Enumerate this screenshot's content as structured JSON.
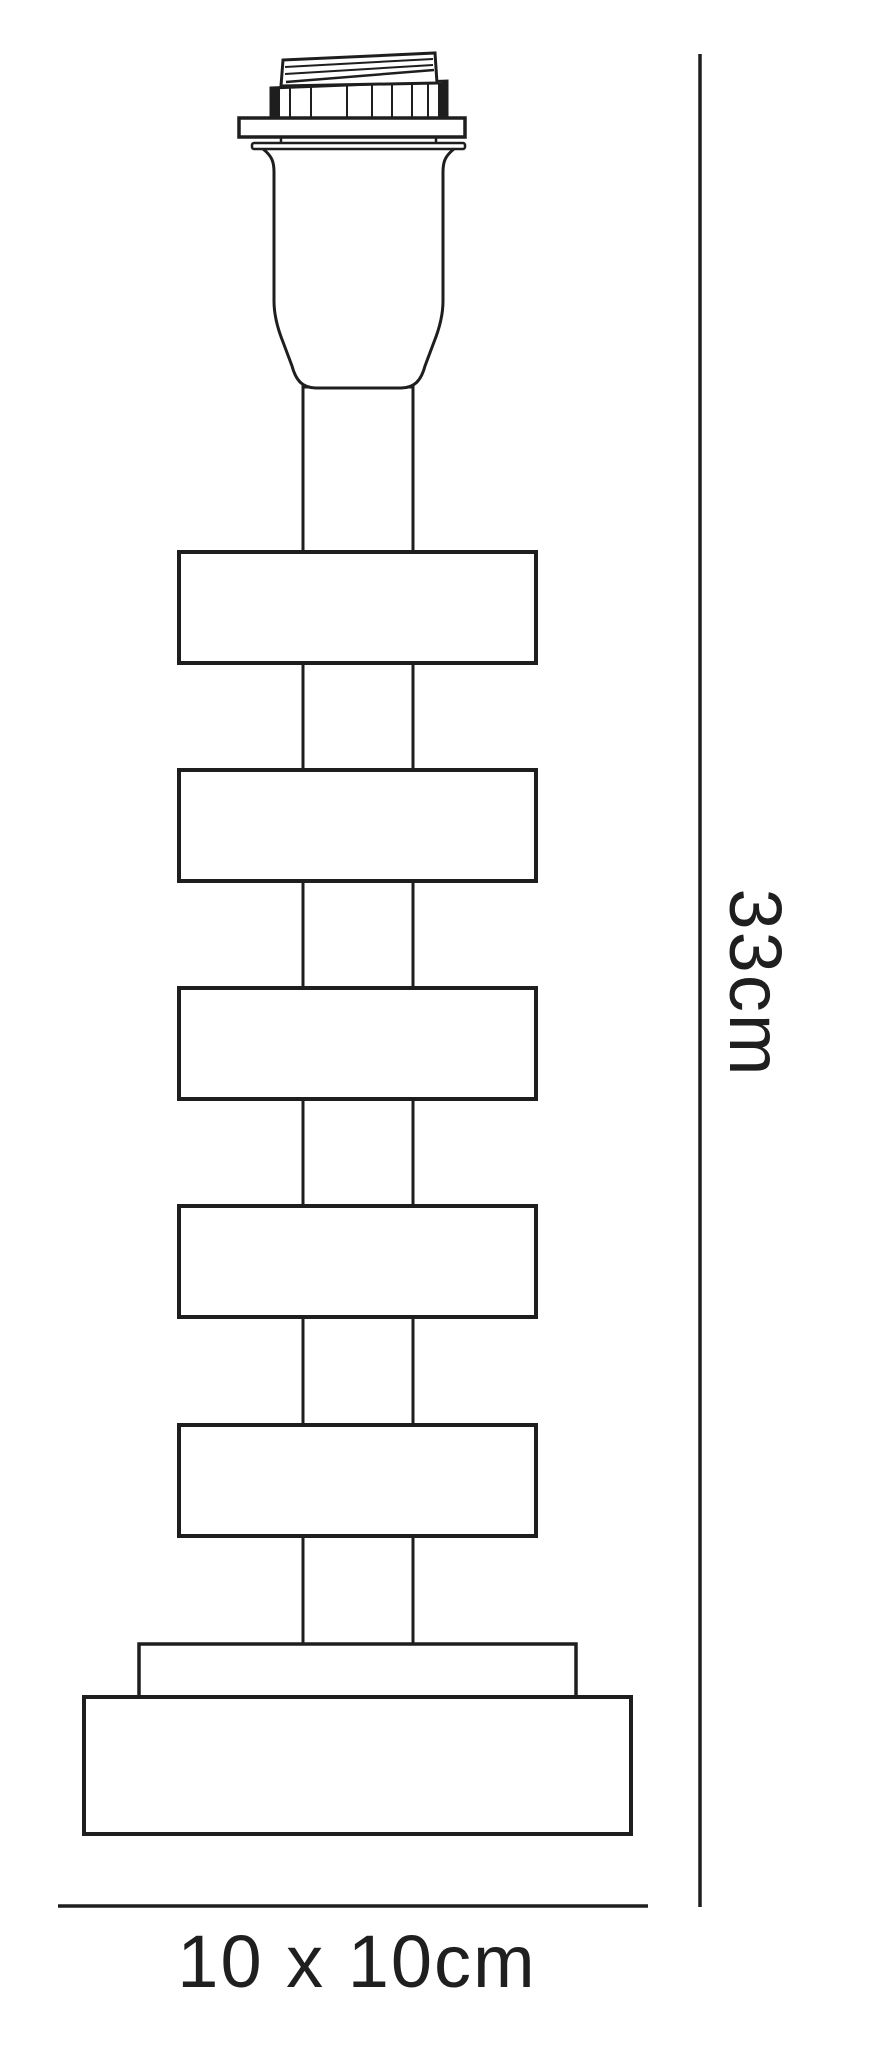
{
  "drawing": {
    "kind": "table lamp base technical line drawing",
    "disc_count": 5,
    "base_step_count": 2
  },
  "dimensions": {
    "height_label": "33cm",
    "footprint_label": "10 x 10cm"
  },
  "colors": {
    "line": "#1e1e1e",
    "text": "#1f1f1f",
    "bg": "#ffffff"
  }
}
